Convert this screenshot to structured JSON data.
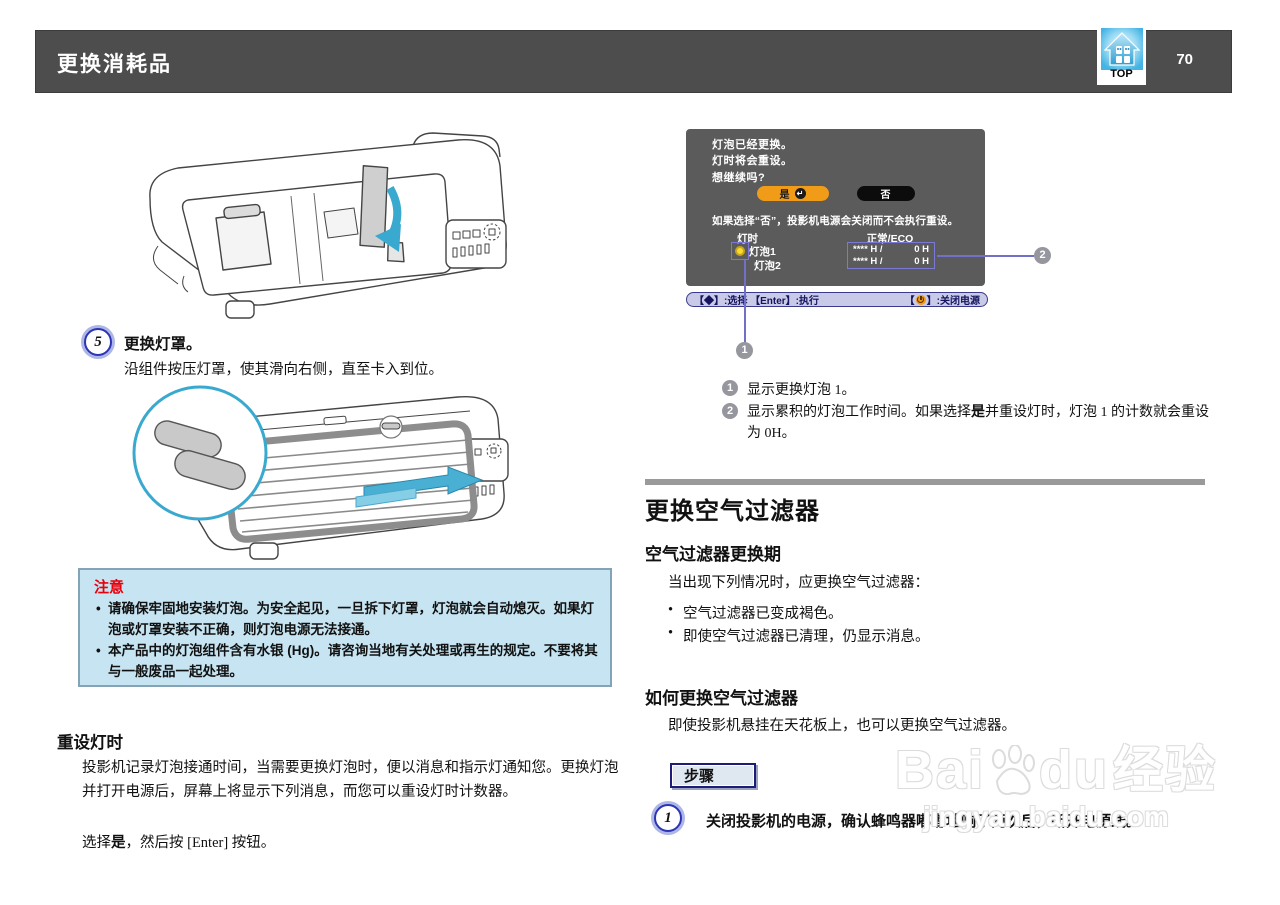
{
  "header": {
    "title": "更换消耗品",
    "page_number": "70",
    "top_label": "TOP"
  },
  "left": {
    "step5": {
      "number": "5",
      "title": "更换灯罩。",
      "body": "沿组件按压灯罩，使其滑向右侧，直至卡入到位。"
    },
    "caution": {
      "title": "注意",
      "bullets": [
        "请确保牢固地安装灯泡。为安全起见，一旦拆下灯罩，灯泡就会自动熄灭。如果灯泡或灯罩安装不正确，则灯泡电源无法接通。",
        "本产品中的灯泡组件含有水银 (Hg)。请咨询当地有关处理或再生的规定。不要将其与一般废品一起处理。"
      ]
    },
    "reset_section": {
      "title": "重设灯时",
      "paragraph": "投影机记录灯泡接通时间，当需要更换灯泡时，便以消息和指示灯通知您。更换灯泡并打开电源后，屏幕上将显示下列消息，而您可以重设灯时计数器。",
      "line_pre": "选择",
      "line_bold": "是",
      "line_post": "，然后按 [Enter] 按钮。"
    }
  },
  "osd": {
    "message_lines": [
      "灯泡已经更换。",
      "灯时将会重设。",
      "想继续吗?"
    ],
    "yes_label": "是",
    "return_glyph": "↵",
    "no_label": "否",
    "note": "如果选择“否”，投影机电源会关闭而不会执行重设。",
    "lamp_hours_label": "灯时",
    "mode_header": "正常/ECO",
    "lamps": [
      {
        "name": "灯泡1",
        "hours_used": "**** H /",
        "hours_reset": "0 H"
      },
      {
        "name": "灯泡2",
        "hours_used": "**** H /",
        "hours_reset": "0 H"
      }
    ],
    "keybar_left": "【◆】:选择 【Enter】:执行",
    "keybar_right_open": "【",
    "keybar_right_close": "】:关闭电源"
  },
  "annotations": [
    {
      "num": "1",
      "text": "显示更换灯泡 1。"
    },
    {
      "num": "2",
      "pre": "显示累积的灯泡工作时间。如果选择",
      "bold": "是",
      "post": "并重设灯时，灯泡 1 的计数就会重设为 0H。"
    }
  ],
  "filter_section": {
    "title": "更换空气过滤器",
    "period": {
      "title": "空气过滤器更换期",
      "intro": "当出现下列情况时，应更换空气过滤器：",
      "bullets": [
        "空气过滤器已变成褐色。",
        "即使空气过滤器已清理，仍显示消息。"
      ]
    },
    "how": {
      "title": "如何更换空气过滤器",
      "intro": "即使投影机悬挂在天花板上，也可以更换空气过滤器。",
      "procedure_label": "步骤",
      "step1_number": "1",
      "step1_text": "关闭投影机的电源，确认蜂鸣器嘟嘟地响了两次后，断开电源线。"
    }
  },
  "watermark": {
    "brand_pre": "Bai",
    "brand_post": "du",
    "brand_suffix": "经验",
    "url": "jingyan.baidu.com"
  },
  "colors": {
    "header_bg": "#4d4d4d",
    "osd_bg": "#5b5b5b",
    "accent_orange": "#f09c18",
    "caution_bg": "#c6e4f1",
    "caution_title_red": "#e8000a",
    "callout_purple": "#7070c8",
    "arrow_blue": "#3aa9cf",
    "keybar_bg": "#c9c9e8"
  }
}
